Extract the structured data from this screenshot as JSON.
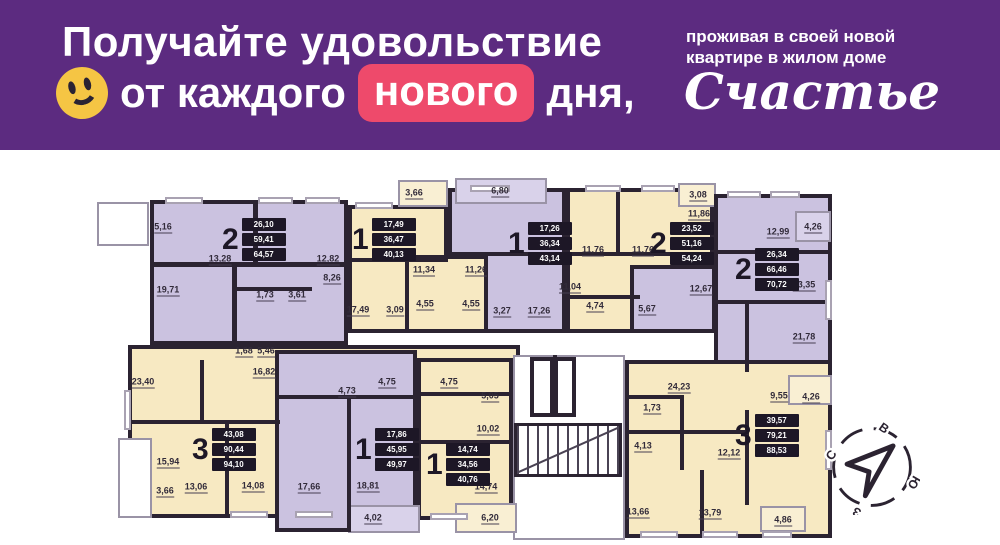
{
  "header": {
    "bg": "#5c2b80",
    "line1": "Получайте удовольствие",
    "line2_pre": "от каждого",
    "line2_highlight": "нового",
    "line2_post": "дня,",
    "highlight_bg": "#ee4a6b",
    "smiley_color": "#f5c544",
    "right_line1": "проживая в своей новой",
    "right_line2": "квартире в жилом доме",
    "brand": "Счастье"
  },
  "plan": {
    "wall_color": "#2b2331",
    "colors": {
      "purple": "#cbc2e0",
      "cream": "#f7e9c2",
      "purple_light": "#d9d2ea",
      "cream_light": "#f9efd3",
      "open": "#ffffff"
    },
    "blocks": [
      {
        "x": 150,
        "y": 200,
        "w": 198,
        "h": 145,
        "c": "purple"
      },
      {
        "x": 128,
        "y": 345,
        "w": 392,
        "h": 173,
        "c": "cream"
      },
      {
        "x": 348,
        "y": 205,
        "w": 100,
        "h": 128,
        "c": "cream"
      },
      {
        "x": 398,
        "y": 180,
        "w": 50,
        "h": 27,
        "c": "cream_light"
      },
      {
        "x": 448,
        "y": 188,
        "w": 118,
        "h": 145,
        "c": "purple"
      },
      {
        "x": 455,
        "y": 178,
        "w": 92,
        "h": 26,
        "c": "purple_light"
      },
      {
        "x": 405,
        "y": 255,
        "w": 83,
        "h": 78,
        "c": "cream"
      },
      {
        "x": 566,
        "y": 188,
        "w": 148,
        "h": 145,
        "c": "cream"
      },
      {
        "x": 678,
        "y": 183,
        "w": 38,
        "h": 24,
        "c": "cream_light"
      },
      {
        "x": 714,
        "y": 194,
        "w": 118,
        "h": 178,
        "c": "purple"
      },
      {
        "x": 630,
        "y": 265,
        "w": 86,
        "h": 68,
        "c": "purple"
      },
      {
        "x": 795,
        "y": 211,
        "w": 36,
        "h": 31,
        "c": "purple_light"
      },
      {
        "x": 513,
        "y": 355,
        "w": 112,
        "h": 185,
        "c": "open"
      },
      {
        "x": 275,
        "y": 350,
        "w": 142,
        "h": 182,
        "c": "purple"
      },
      {
        "x": 417,
        "y": 358,
        "w": 96,
        "h": 162,
        "c": "cream"
      },
      {
        "x": 625,
        "y": 360,
        "w": 207,
        "h": 178,
        "c": "cream"
      },
      {
        "x": 788,
        "y": 375,
        "w": 44,
        "h": 30,
        "c": "cream_light"
      },
      {
        "x": 760,
        "y": 506,
        "w": 46,
        "h": 26,
        "c": "cream_light"
      },
      {
        "x": 348,
        "y": 505,
        "w": 72,
        "h": 28,
        "c": "purple_light"
      },
      {
        "x": 455,
        "y": 503,
        "w": 62,
        "h": 30,
        "c": "cream_light"
      },
      {
        "x": 97,
        "y": 202,
        "w": 52,
        "h": 44,
        "c": "open"
      },
      {
        "x": 118,
        "y": 438,
        "w": 34,
        "h": 80,
        "c": "open"
      }
    ],
    "walls": [
      {
        "x": 253,
        "y": 200,
        "w": 5,
        "h": 62
      },
      {
        "x": 150,
        "y": 262,
        "w": 198,
        "h": 5
      },
      {
        "x": 232,
        "y": 262,
        "w": 5,
        "h": 83
      },
      {
        "x": 237,
        "y": 287,
        "w": 75,
        "h": 4
      },
      {
        "x": 348,
        "y": 258,
        "w": 100,
        "h": 4
      },
      {
        "x": 448,
        "y": 252,
        "w": 118,
        "h": 4
      },
      {
        "x": 566,
        "y": 252,
        "w": 148,
        "h": 4
      },
      {
        "x": 616,
        "y": 188,
        "w": 4,
        "h": 64
      },
      {
        "x": 566,
        "y": 295,
        "w": 74,
        "h": 4
      },
      {
        "x": 714,
        "y": 250,
        "w": 118,
        "h": 4
      },
      {
        "x": 745,
        "y": 300,
        "w": 4,
        "h": 72
      },
      {
        "x": 714,
        "y": 300,
        "w": 118,
        "h": 4
      },
      {
        "x": 200,
        "y": 360,
        "w": 4,
        "h": 60
      },
      {
        "x": 128,
        "y": 420,
        "w": 152,
        "h": 4
      },
      {
        "x": 225,
        "y": 424,
        "w": 4,
        "h": 94
      },
      {
        "x": 347,
        "y": 395,
        "w": 4,
        "h": 137
      },
      {
        "x": 275,
        "y": 395,
        "w": 142,
        "h": 4
      },
      {
        "x": 417,
        "y": 392,
        "w": 96,
        "h": 4
      },
      {
        "x": 417,
        "y": 440,
        "w": 96,
        "h": 4
      },
      {
        "x": 625,
        "y": 430,
        "w": 120,
        "h": 4
      },
      {
        "x": 700,
        "y": 470,
        "w": 4,
        "h": 68
      },
      {
        "x": 745,
        "y": 410,
        "w": 4,
        "h": 95
      },
      {
        "x": 625,
        "y": 395,
        "w": 55,
        "h": 4
      },
      {
        "x": 680,
        "y": 395,
        "w": 4,
        "h": 75
      },
      {
        "x": 553,
        "y": 355,
        "w": 4,
        "h": 62
      }
    ],
    "windows": [
      {
        "x": 165,
        "y": 197,
        "w": 38,
        "h": 7
      },
      {
        "x": 258,
        "y": 197,
        "w": 35,
        "h": 7
      },
      {
        "x": 305,
        "y": 197,
        "w": 35,
        "h": 7
      },
      {
        "x": 355,
        "y": 202,
        "w": 38,
        "h": 7
      },
      {
        "x": 470,
        "y": 185,
        "w": 40,
        "h": 7
      },
      {
        "x": 585,
        "y": 185,
        "w": 36,
        "h": 7
      },
      {
        "x": 641,
        "y": 185,
        "w": 34,
        "h": 7
      },
      {
        "x": 727,
        "y": 191,
        "w": 34,
        "h": 7
      },
      {
        "x": 770,
        "y": 191,
        "w": 30,
        "h": 7
      },
      {
        "x": 230,
        "y": 511,
        "w": 38,
        "h": 7
      },
      {
        "x": 295,
        "y": 511,
        "w": 38,
        "h": 7
      },
      {
        "x": 430,
        "y": 513,
        "w": 38,
        "h": 7
      },
      {
        "x": 640,
        "y": 531,
        "w": 38,
        "h": 7
      },
      {
        "x": 702,
        "y": 531,
        "w": 36,
        "h": 7
      },
      {
        "x": 762,
        "y": 531,
        "w": 30,
        "h": 7
      },
      {
        "x": 124,
        "y": 390,
        "w": 7,
        "h": 40
      },
      {
        "x": 825,
        "y": 280,
        "w": 7,
        "h": 40
      },
      {
        "x": 825,
        "y": 430,
        "w": 7,
        "h": 40
      }
    ],
    "labels": [
      {
        "t": "5,16",
        "x": 163,
        "y": 228
      },
      {
        "t": "13,28",
        "x": 220,
        "y": 260
      },
      {
        "t": "12,82",
        "x": 328,
        "y": 260
      },
      {
        "t": "8,26",
        "x": 332,
        "y": 279
      },
      {
        "t": "19,71",
        "x": 168,
        "y": 291
      },
      {
        "t": "1,73",
        "x": 265,
        "y": 296
      },
      {
        "t": "3,61",
        "x": 297,
        "y": 296
      },
      {
        "t": "3,66",
        "x": 414,
        "y": 194
      },
      {
        "t": "17,49",
        "x": 358,
        "y": 311
      },
      {
        "t": "3,09",
        "x": 395,
        "y": 311
      },
      {
        "t": "1,68",
        "x": 244,
        "y": 352
      },
      {
        "t": "5,46",
        "x": 266,
        "y": 352
      },
      {
        "t": "6,80",
        "x": 500,
        "y": 192
      },
      {
        "t": "11,34",
        "x": 424,
        "y": 271
      },
      {
        "t": "11,26",
        "x": 476,
        "y": 271
      },
      {
        "t": "4,55",
        "x": 425,
        "y": 305
      },
      {
        "t": "4,55",
        "x": 471,
        "y": 305
      },
      {
        "t": "3,27",
        "x": 502,
        "y": 312
      },
      {
        "t": "17,26",
        "x": 539,
        "y": 312
      },
      {
        "t": "11,76",
        "x": 593,
        "y": 251
      },
      {
        "t": "11,76",
        "x": 643,
        "y": 251
      },
      {
        "t": "11,04",
        "x": 570,
        "y": 288
      },
      {
        "t": "4,74",
        "x": 595,
        "y": 307
      },
      {
        "t": "5,67",
        "x": 647,
        "y": 310
      },
      {
        "t": "3,08",
        "x": 698,
        "y": 196
      },
      {
        "t": "11,86",
        "x": 699,
        "y": 215
      },
      {
        "t": "12,99",
        "x": 778,
        "y": 233
      },
      {
        "t": "4,26",
        "x": 813,
        "y": 228
      },
      {
        "t": "12,67",
        "x": 701,
        "y": 290
      },
      {
        "t": "13,35",
        "x": 804,
        "y": 286
      },
      {
        "t": "21,78",
        "x": 804,
        "y": 338
      },
      {
        "t": "23,40",
        "x": 143,
        "y": 383
      },
      {
        "t": "16,82",
        "x": 264,
        "y": 373
      },
      {
        "t": "15,94",
        "x": 168,
        "y": 463
      },
      {
        "t": "13,06",
        "x": 196,
        "y": 488
      },
      {
        "t": "14,08",
        "x": 253,
        "y": 487
      },
      {
        "t": "3,66",
        "x": 165,
        "y": 492
      },
      {
        "t": "4,73",
        "x": 347,
        "y": 392
      },
      {
        "t": "4,75",
        "x": 387,
        "y": 383
      },
      {
        "t": "17,66",
        "x": 309,
        "y": 488
      },
      {
        "t": "18,81",
        "x": 368,
        "y": 487
      },
      {
        "t": "4,02",
        "x": 373,
        "y": 519
      },
      {
        "t": "4,75",
        "x": 449,
        "y": 383
      },
      {
        "t": "5,05",
        "x": 490,
        "y": 397
      },
      {
        "t": "10,02",
        "x": 488,
        "y": 430
      },
      {
        "t": "14,74",
        "x": 486,
        "y": 488
      },
      {
        "t": "6,20",
        "x": 490,
        "y": 519
      },
      {
        "t": "24,23",
        "x": 679,
        "y": 388
      },
      {
        "t": "1,73",
        "x": 652,
        "y": 409
      },
      {
        "t": "4,13",
        "x": 643,
        "y": 447
      },
      {
        "t": "13,66",
        "x": 638,
        "y": 513
      },
      {
        "t": "13,79",
        "x": 710,
        "y": 514
      },
      {
        "t": "12,12",
        "x": 729,
        "y": 454
      },
      {
        "t": "9,55",
        "x": 779,
        "y": 397
      },
      {
        "t": "4,26",
        "x": 811,
        "y": 398
      },
      {
        "t": "4,86",
        "x": 783,
        "y": 521
      }
    ],
    "units": [
      {
        "n": "2",
        "v": [
          "26,10",
          "59,41",
          "64,57"
        ],
        "x": 222,
        "y": 218
      },
      {
        "n": "1",
        "v": [
          "17,49",
          "36,47",
          "40,13"
        ],
        "x": 352,
        "y": 218
      },
      {
        "n": "1",
        "v": [
          "17,26",
          "36,34",
          "43,14"
        ],
        "x": 508,
        "y": 222
      },
      {
        "n": "2",
        "v": [
          "23,52",
          "51,16",
          "54,24"
        ],
        "x": 650,
        "y": 222
      },
      {
        "n": "2",
        "v": [
          "26,34",
          "66,46",
          "70,72"
        ],
        "x": 735,
        "y": 248
      },
      {
        "n": "3",
        "v": [
          "43,08",
          "90,44",
          "94,10"
        ],
        "x": 192,
        "y": 428
      },
      {
        "n": "1",
        "v": [
          "17,86",
          "45,95",
          "49,97"
        ],
        "x": 355,
        "y": 428
      },
      {
        "n": "1",
        "v": [
          "14,74",
          "34,56",
          "40,76"
        ],
        "x": 426,
        "y": 443
      },
      {
        "n": "3",
        "v": [
          "39,57",
          "79,21",
          "88,53"
        ],
        "x": 735,
        "y": 414
      }
    ],
    "stair": {
      "x": 514,
      "y": 423,
      "w": 108,
      "h": 54
    },
    "elevators": [
      {
        "x": 530,
        "y": 357,
        "w": 24,
        "h": 60
      },
      {
        "x": 554,
        "y": 357,
        "w": 22,
        "h": 60
      }
    ],
    "compass": {
      "letters": [
        "С",
        "В",
        "Ю",
        "З"
      ]
    }
  }
}
